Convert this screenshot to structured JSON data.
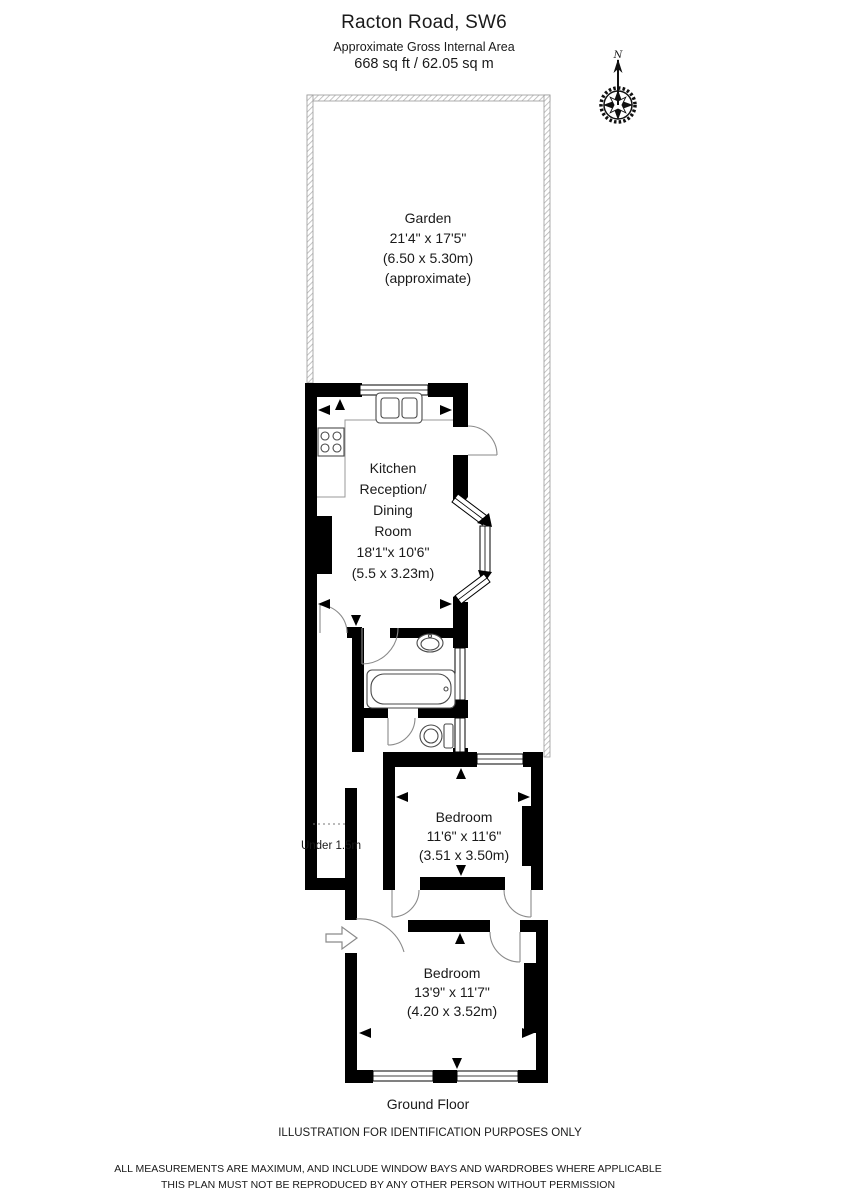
{
  "header": {
    "title": "Racton Road, SW6",
    "subtitle": "Approximate Gross Internal Area",
    "area": "668 sq ft  /  62.05 sq m"
  },
  "compass": {
    "north_label": "N"
  },
  "rooms": {
    "garden": {
      "name": "Garden",
      "dims_imperial": "21'4\" x 17'5\"",
      "dims_metric": "(6.50 x 5.30m)",
      "note": "(approximate)"
    },
    "kitchen": {
      "name_lines": [
        "Kitchen",
        "Reception/",
        "Dining",
        "Room"
      ],
      "dims_imperial": "18'1\"x 10'6\"",
      "dims_metric": "(5.5 x 3.23m)"
    },
    "bedroom1": {
      "name": "Bedroom",
      "dims_imperial": "11'6\" x 11'6\"",
      "dims_metric": "(3.51 x 3.50m)"
    },
    "bedroom2": {
      "name": "Bedroom",
      "dims_imperial": "13'9\" x 11'7\"",
      "dims_metric": "(4.20 x 3.52m)"
    },
    "under_stairs": {
      "line1": "Under",
      "line2": "1.5m"
    }
  },
  "footer": {
    "floor_label": "Ground Floor",
    "disclaimer": "ILLUSTRATION FOR IDENTIFICATION PURPOSES ONLY",
    "legal_line1": "ALL MEASUREMENTS ARE MAXIMUM, AND INCLUDE WINDOW BAYS AND WARDROBES WHERE APPLICABLE",
    "legal_line2": "THIS PLAN MUST NOT BE REPRODUCED BY ANY OTHER PERSON WITHOUT PERMISSION"
  },
  "colors": {
    "wall": "#000000",
    "garden_border": "#b5b5b5",
    "text": "#1a1a1a"
  }
}
